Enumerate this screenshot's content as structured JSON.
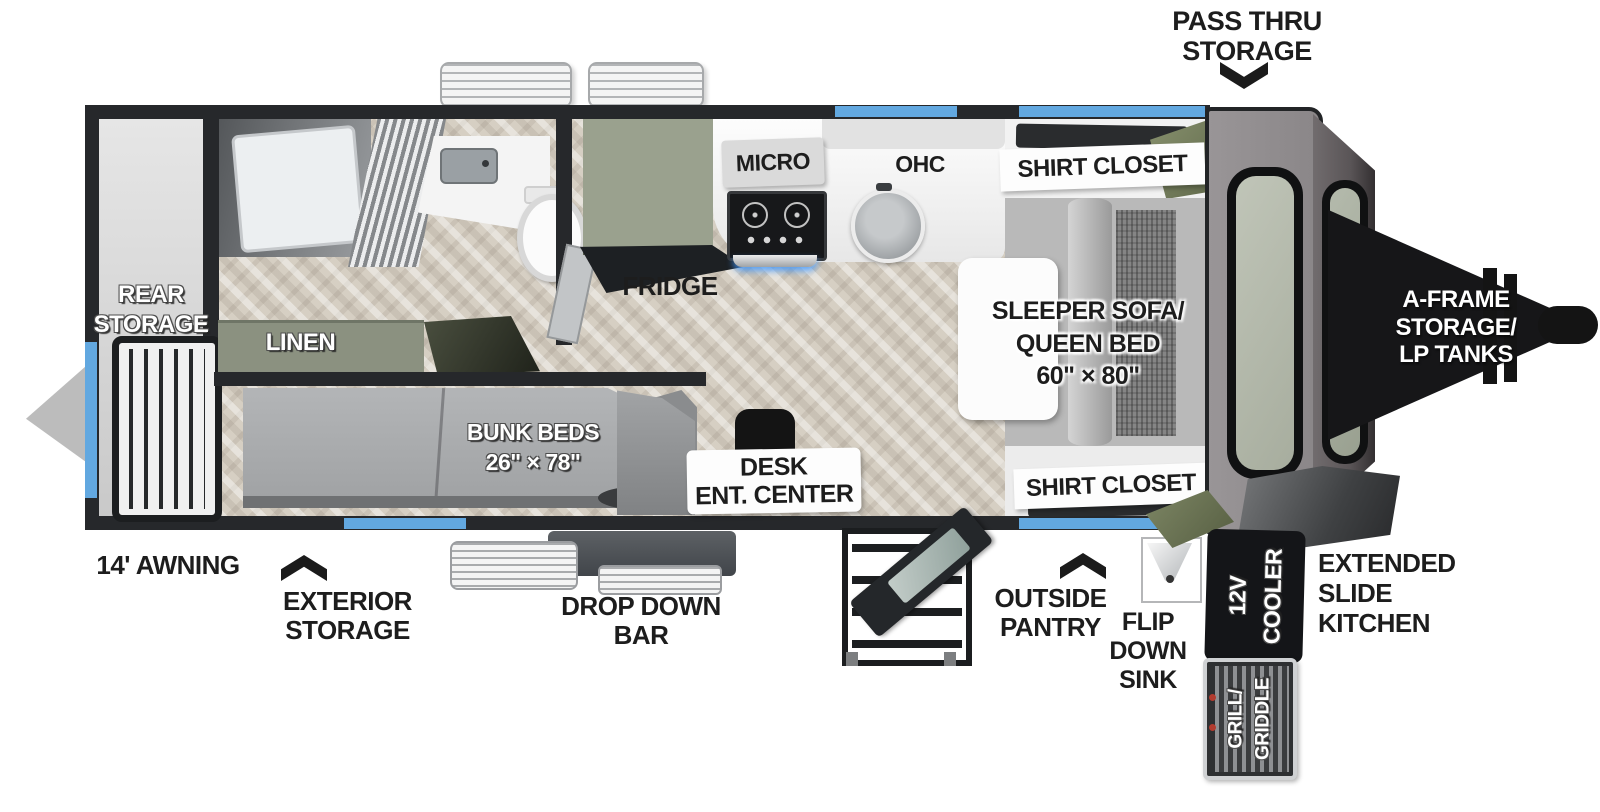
{
  "callouts": {
    "pass_thru_storage": [
      "PASS THRU",
      "STORAGE"
    ],
    "awning": "14' AWNING",
    "exterior_storage": [
      "EXTERIOR",
      "STORAGE"
    ],
    "drop_down_bar": [
      "DROP DOWN",
      "BAR"
    ],
    "outside_pantry": [
      "OUTSIDE",
      "PANTRY"
    ],
    "flip_down_sink": [
      "FLIP",
      "DOWN",
      "SINK"
    ],
    "extended_slide_kitchen": [
      "EXTENDED",
      "SLIDE",
      "KITCHEN"
    ],
    "a_frame_storage": [
      "A-FRAME",
      "STORAGE/",
      "LP TANKS"
    ]
  },
  "rooms": {
    "rear_storage": [
      "REAR",
      "STORAGE"
    ],
    "linen": "LINEN",
    "fridge": "FRIDGE",
    "micro": "MICRO",
    "ohc": "OHC",
    "shirt_closet_top": "SHIRT CLOSET",
    "shirt_closet_bottom": "SHIRT CLOSET",
    "sleeper_sofa": [
      "SLEEPER SOFA/",
      "QUEEN BED",
      "60\" × 80\""
    ],
    "bunk_beds": [
      "BUNK BEDS",
      "26\" × 78\""
    ],
    "desk_ent_center": [
      "DESK",
      "ENT. CENTER"
    ]
  },
  "equipment": {
    "cooler_12v": [
      "12V",
      "COOLER"
    ],
    "grill_griddle": [
      "GRILL/",
      "GRIDDLE"
    ]
  },
  "colors": {
    "wall": "#26282b",
    "accent_blue": "#62a8e0",
    "olive_green": "#7d8568",
    "sage_green": "#9aa18e",
    "floor_wood": "#d6cfc3",
    "label_black": "#1d1d1d"
  }
}
